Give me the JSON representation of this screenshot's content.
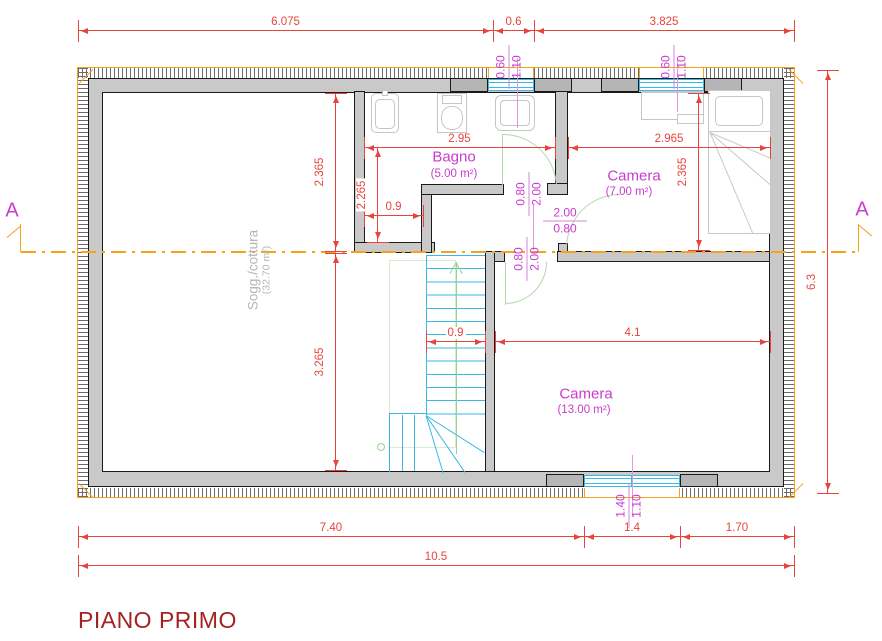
{
  "title": "PIANO PRIMO",
  "section_marker": {
    "left": "A",
    "right": "A"
  },
  "rooms": {
    "soggiorno": {
      "name": "Sogg./cottura",
      "area": "(32.70 m²)"
    },
    "bagno": {
      "name": "Bagno",
      "area": "(5.00 m²)"
    },
    "camera_small": {
      "name": "Camera",
      "area": "(7.00 m²)"
    },
    "camera_large": {
      "name": "Camera",
      "area": "(13.00 m²)"
    }
  },
  "dimensions": {
    "top_chain": [
      "6.075",
      "0.6",
      "3.825"
    ],
    "bottom_chain": [
      "7.40",
      "1.4",
      "1.70"
    ],
    "overall_width": "10.5",
    "overall_height": "6.3",
    "left_chain": [
      "2.365",
      "3.265"
    ],
    "bagno_width": "2.95",
    "bagno_depth": "2.265",
    "bagno_niche_width": "0.9",
    "camera_small_width": "2.965",
    "camera_small_depth": "2.365",
    "stair_width": "0.9",
    "camera_large_width": "4.1"
  },
  "openings": {
    "bagno_window": {
      "w": "0.60",
      "h": "1.10"
    },
    "camera_small_window": {
      "w": "0.60",
      "h": "1.10"
    },
    "camera_large_window": {
      "w": "1.40",
      "h": "1.10"
    },
    "bagno_door": {
      "w": "0.80",
      "h": "2.00"
    },
    "camera_small_door": {
      "w": "2.00",
      "h": "0.80"
    },
    "camera_large_door": {
      "w": "0.80",
      "h": "2.00"
    }
  },
  "colors": {
    "dimension_red": "#e8443c",
    "label_magenta": "#c93ccc",
    "section_orange": "#f7a21b",
    "window_cyan": "#38b9e6",
    "wall_gray": "#c9c9c9",
    "title_maroon": "#a32323"
  }
}
